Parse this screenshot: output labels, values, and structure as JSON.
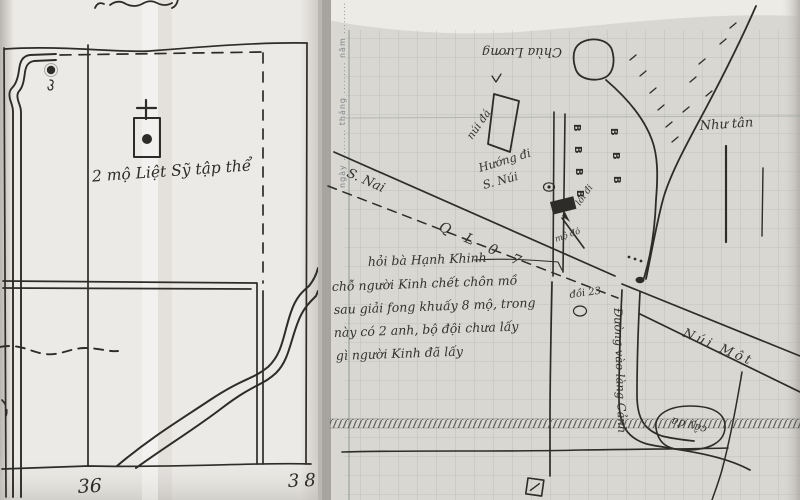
{
  "left_map": {
    "caption": "2 mộ Liệt Sỹ tập thể",
    "grid_number_left": "36",
    "grid_number_right": "38"
  },
  "right_map": {
    "margin_text": "ngày ......... tháng ......... năm .........",
    "label_top_upside_down": "Chùa Lương",
    "label_rock": "núi đá",
    "label_direction_line1": "Hướng đi",
    "label_direction_line2": "S. Núi",
    "road_label_river": "S. Nai",
    "road_label_highway": "Q L 0 7",
    "road_label_mountain": "Núi Một",
    "label_building": "Như tân",
    "label_junction": "đồi 23",
    "label_grave_pointer": "mộ đó",
    "label_path": "lối đi",
    "road_label_village": "Đường vào làng Cảnh",
    "label_banyan_circled": "cây đa",
    "house_symbol": "B",
    "note_lines": [
      "hỏi bà Hạnh Khinh",
      "chỗ người Kinh chết chôn mồ",
      "sau giải fong khuấy 8 mộ, trong",
      "này có 2 anh, bộ đội chưa lấy",
      "gì người Kinh đã lấy"
    ]
  },
  "colors": {
    "ink": "#2d2c28",
    "paper_left": "#eceae6",
    "paper_right": "#d9d7d2",
    "grid_line": "#a9b2ad"
  }
}
